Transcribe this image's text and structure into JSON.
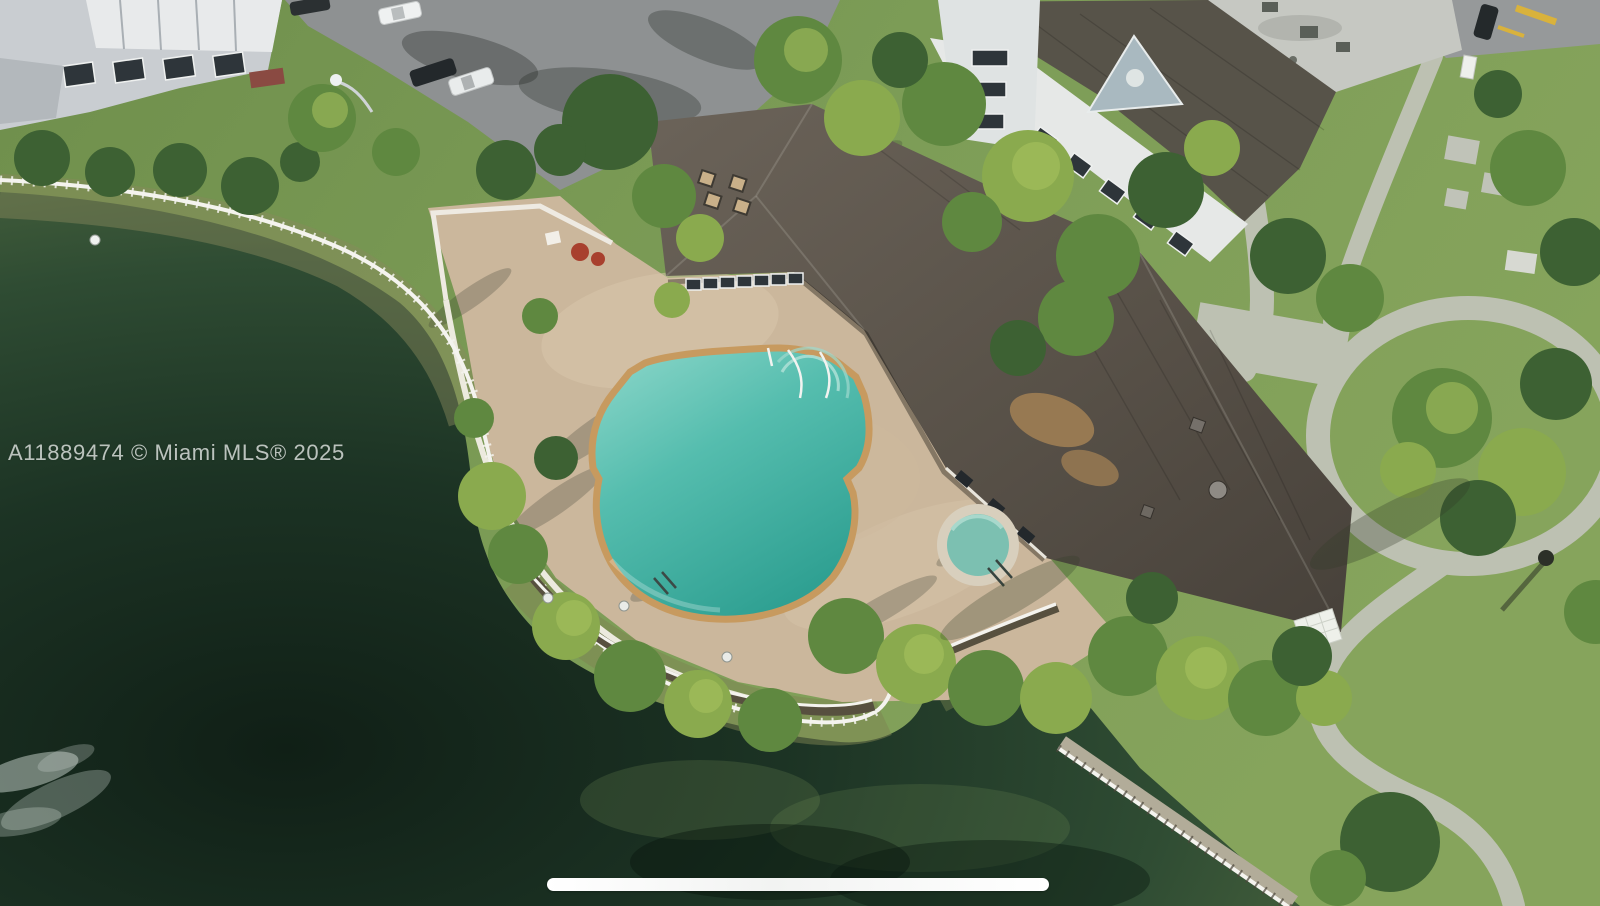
{
  "watermark": {
    "text": "A11889474 © Miami MLS® 2025",
    "color": "#dee3df"
  },
  "home_indicator": {
    "color": "#ffffff"
  },
  "palette": {
    "lake_deep": "#14271d",
    "lake_mid": "#2c4731",
    "lake_shallow": "#83895a",
    "lawn": "#7a9a55",
    "deck_pavers": "#cbb79c",
    "clubhouse_roof": "#575047",
    "pool_water_light": "#8fd8cb",
    "pool_water_deep": "#2fa092",
    "pool_coping": "#c79a5f",
    "spa_water": "#6fbfae",
    "fence_white": "#f4f3ee",
    "walkway_concrete": "#bdc1b2",
    "building_white": "#e6e8e7",
    "building_roof_flat": "#c6c8c2",
    "building_roof_dark": "#575349",
    "asphalt": "#8e9192",
    "curb_yellow": "#d9b23c"
  }
}
